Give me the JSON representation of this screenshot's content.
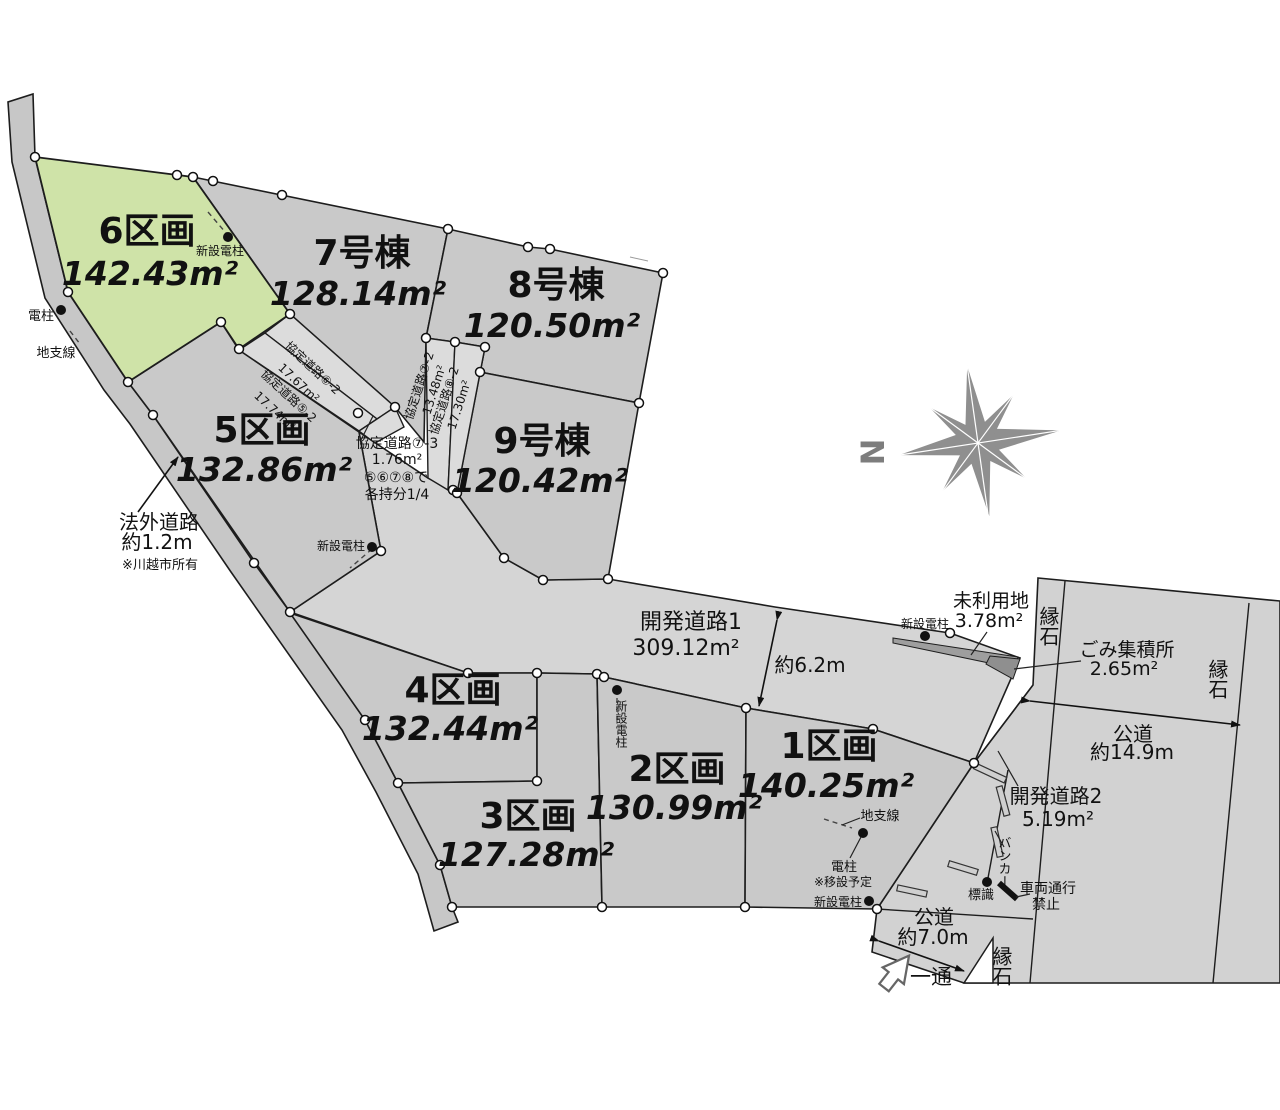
{
  "lots": [
    {
      "name": "6区画",
      "area": "142.43m²"
    },
    {
      "name": "7号棟",
      "area": "128.14m²"
    },
    {
      "name": "8号棟",
      "area": "120.50m²"
    },
    {
      "name": "9号棟",
      "area": "120.42m²"
    },
    {
      "name": "5区画",
      "area": "132.86m²"
    },
    {
      "name": "4区画",
      "area": "132.44m²"
    },
    {
      "name": "3区画",
      "area": "127.28m²"
    },
    {
      "name": "2区画",
      "area": "130.99m²"
    },
    {
      "name": "1区画",
      "area": "140.25m²"
    }
  ],
  "kyotei": [
    {
      "label": "協定道路⑥-2",
      "area": "17.67m²"
    },
    {
      "label": "協定道路⑤-2",
      "area": "17.74m²"
    },
    {
      "label": "協定道路⑦-2",
      "area": "13.48m²"
    },
    {
      "label": "協定道路⑧-2",
      "area": "17.30m²"
    },
    {
      "label": "協定道路⑦-3",
      "area": "1.76m²",
      "note1": "⑤⑥⑦⑧で",
      "note2": "各持分1/4"
    }
  ],
  "dev": [
    {
      "label": "開発道路1",
      "area": "309.12m²"
    },
    {
      "label": "開発道路2",
      "area": "5.19m²"
    }
  ],
  "public": {
    "right_name": "公道",
    "right_width": "約14.9m",
    "bottom_name": "公道",
    "bottom_width": "約7.0m",
    "dev1_width": "約6.2m"
  },
  "hogai": {
    "l1": "法外道路",
    "l2": "約1.2m",
    "l3": "※川越市所有"
  },
  "features": {
    "unused": "未利用地",
    "unused_area": "3.78m²",
    "garbage": "ごみ集積所",
    "garbage_area": "2.65m²",
    "curb": "縁石",
    "sign": "標識",
    "novehicle1": "車両通行",
    "novehicle2": "禁止",
    "bunker": "バンカー",
    "oneway": "一通",
    "north": "N"
  },
  "poles": {
    "denchu": "電柱",
    "guywire": "地支線",
    "newpole": "新設電柱",
    "relocate1": "電柱",
    "relocate2": "※移設予定"
  }
}
